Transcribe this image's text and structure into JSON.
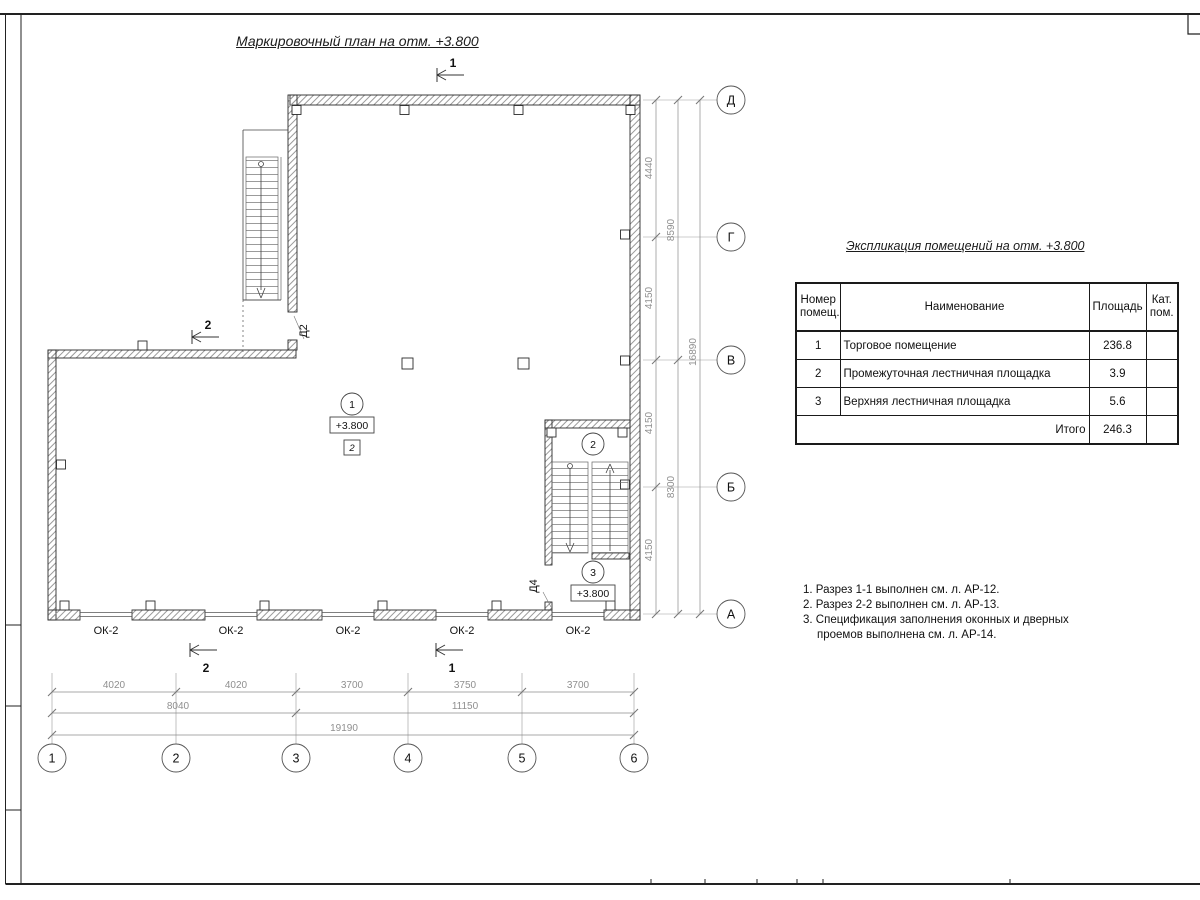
{
  "titles": {
    "plan": "Маркировочный план на отм. +3.800",
    "expl": "Экспликация помещений на отм. +3.800"
  },
  "table": {
    "h_num1": "Номер",
    "h_num2": "помещ.",
    "h_name": "Наименование",
    "h_area": "Площадь",
    "h_cat1": "Кат.",
    "h_cat2": "пом.",
    "rows": [
      {
        "num": "1",
        "name": "Торговое помещение",
        "area": "236.8",
        "cat": ""
      },
      {
        "num": "2",
        "name": "Промежуточная лестничная площадка",
        "area": "3.9",
        "cat": ""
      },
      {
        "num": "3",
        "name": "Верхняя лестничная площадка",
        "area": "5.6",
        "cat": ""
      }
    ],
    "total_label": "Итого",
    "total_area": "246.3"
  },
  "notes": [
    "1. Разрез 1-1 выполнен см. л. АР-12.",
    "2. Разрез 2-2 выполнен см. л. АР-13.",
    "3. Спецификация заполнения оконных и дверных",
    "проемов выполнена см. л. АР-14."
  ],
  "axes": {
    "h": [
      "1",
      "2",
      "3",
      "4",
      "5",
      "6"
    ],
    "v": [
      "Д",
      "Г",
      "В",
      "Б",
      "А"
    ]
  },
  "dims": {
    "b1": [
      "4020",
      "4020",
      "3700",
      "3750",
      "3700"
    ],
    "b2": [
      "8040",
      "11150"
    ],
    "b3": [
      "19190"
    ],
    "r1": [
      "4440",
      "4150",
      "4150",
      "4150"
    ],
    "r2": [
      "8590",
      "8300"
    ],
    "r3": [
      "16890"
    ]
  },
  "window_label": "ОК-2",
  "rooms": {
    "r1": {
      "num": "1",
      "elev": "+3.800",
      "finish": "2"
    },
    "r2": {
      "num": "2"
    },
    "r3": {
      "num": "3",
      "elev": "+3.800"
    }
  },
  "doors": {
    "d2": "Д2",
    "d4": "Д4"
  },
  "sections": {
    "top": "1",
    "left": "2",
    "bottom_left": "2",
    "bottom_right": "1"
  }
}
